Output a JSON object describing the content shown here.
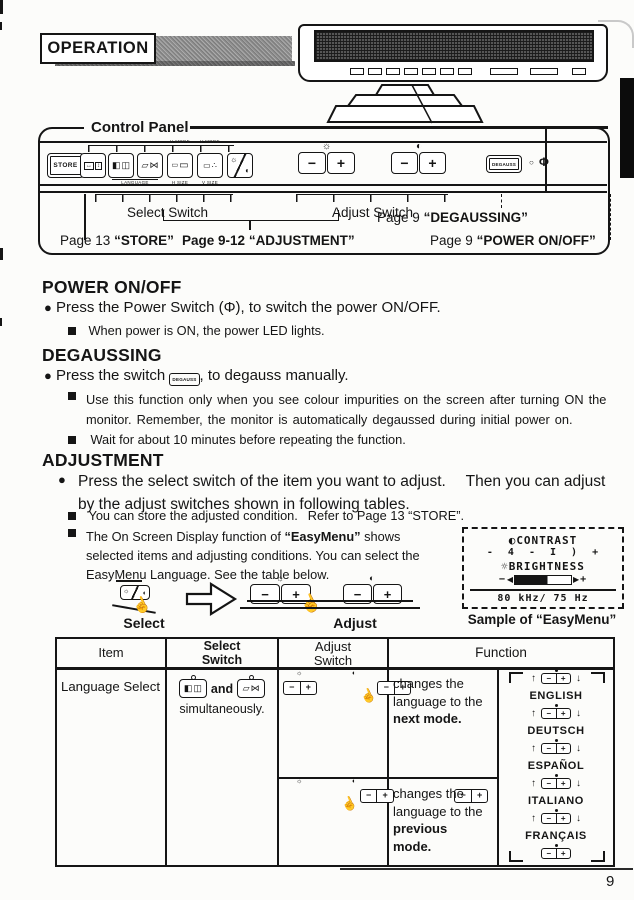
{
  "page": {
    "number": "9"
  },
  "masthead": {
    "title": "OPERATION"
  },
  "control_panel": {
    "label": "Control Panel",
    "store": "STORE",
    "degauss": "DEGAUSS",
    "micro": {
      "h_more": "H MORE",
      "v_more": "V MORE",
      "language": "LANGUAGE",
      "h_size": "H SIZE",
      "v_size": "V SIZE"
    },
    "callouts": {
      "select": "Select Switch",
      "adjust": "Adjust Switch",
      "store_page": "Page 13",
      "store_ref": "“STORE”",
      "adjustment_page": "Page 9-12",
      "adjustment_ref": "“ADJUSTMENT”",
      "degauss_page": "Page 9",
      "degauss_ref": "“DEGAUSSING”",
      "power_page": "Page 9",
      "power_ref": "“POWER ON/OFF”"
    }
  },
  "icons": {
    "sun": "☼",
    "contrast": "◐",
    "arrow_h": "↔",
    "arrow_v": "↕",
    "half_square": "◧",
    "split_square": "◫",
    "parallelogram": "▱",
    "bowtie": "⋈",
    "rect": "▭",
    "dots": "∴",
    "minus": "−",
    "plus": "+",
    "power": "Φ",
    "led": "○",
    "hand": "☝",
    "up": "↑",
    "down": "↓",
    "bullet": "●"
  },
  "sections": {
    "power": {
      "heading": "POWER ON/OFF",
      "bullet": "Press the Power Switch (Φ), to switch the power ON/OFF.",
      "note1": "When power is ON, the power LED lights."
    },
    "degauss": {
      "heading": "DEGAUSSING",
      "bullet_pre": "Press the switch",
      "key": "DEGAUSS",
      "bullet_post": ", to degauss manually.",
      "note1": "Use this function only when you see colour impurities on the screen after turning ON the monitor. Remember, the monitor is automatically degaussed during initial power on.",
      "note2": "Wait for about 10 minutes before repeating the function."
    },
    "adjustment": {
      "heading": "ADJUSTMENT",
      "bullet": "Press the select switch of the item you want to adjust.  Then you can adjust by the adjust switches shown in following tables.",
      "note1": "You can store the adjusted condition.  Refer to Page 13 “STORE”.",
      "note2_pre": "The On Screen Display function of ",
      "note2_em": "“EasyMenu”",
      "note2_post": " shows selected items and adjusting conditions. You can select the EasyMenu Language. See the table below."
    }
  },
  "easymenu": {
    "contrast": "CONTRAST",
    "contrast_scale": "- 4 - I ) +",
    "brightness": "BRIGHTNESS",
    "freq": "80 kHz/ 75 Hz",
    "caption_pre": "Sample of",
    "caption_em": "“EasyMenu”"
  },
  "flow": {
    "select": "Select",
    "adjust": "Adjust"
  },
  "table": {
    "headers": {
      "item": "Item",
      "select1": "Select",
      "select2": "Switch",
      "adjust1": "Adjust",
      "adjust2": "Switch",
      "function": "Function"
    },
    "item": "Language Select",
    "select_and": "and",
    "select_note": "simultaneously.",
    "rows": [
      {
        "l1": "changes the",
        "l2": "language to the",
        "em1": "next mode.",
        "em2": ""
      },
      {
        "l1": "changes the",
        "l2": "language to the",
        "em1": "previous",
        "em2": "mode."
      }
    ],
    "languages": [
      "ENGLISH",
      "DEUTSCH",
      "ESPAÑOL",
      "ITALIANO",
      "FRANÇAIS"
    ]
  }
}
